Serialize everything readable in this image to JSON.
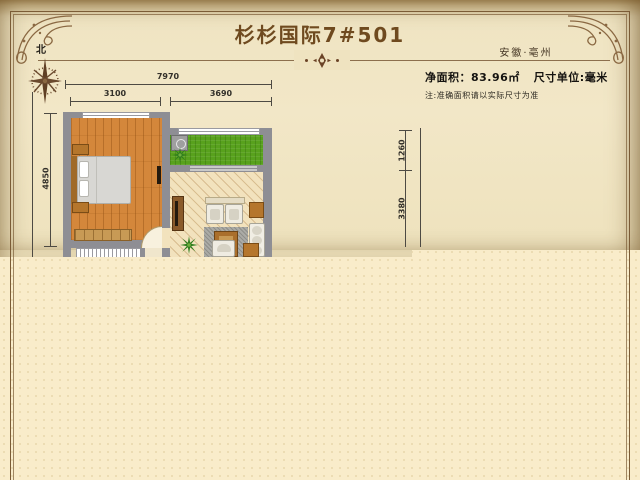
{
  "header": {
    "title": "杉杉国际7#501",
    "location": "安徽·亳州"
  },
  "info": {
    "net_area_label": "净面积：",
    "net_area_value": "83.96㎡",
    "unit_text": "尺寸单位:毫米",
    "note": "注:准确面积请以实际尺寸为准"
  },
  "compass": {
    "north": "北"
  },
  "dimensions": {
    "total_width": "7970",
    "bedroom_width": "3100",
    "living_width": "3690",
    "left_height": "4850",
    "right_upper": "1260",
    "right_lower": "3380"
  },
  "colors": {
    "title": "#6f4a1f",
    "cream": "#f9ecca",
    "parchment": "#efe3c0",
    "frame": "#7b5c36",
    "wall": "#8e8e94",
    "bedroom_floor": "#d4873b",
    "balcony_floor": "#58a11d",
    "living_floor": "#f2e2bd"
  }
}
